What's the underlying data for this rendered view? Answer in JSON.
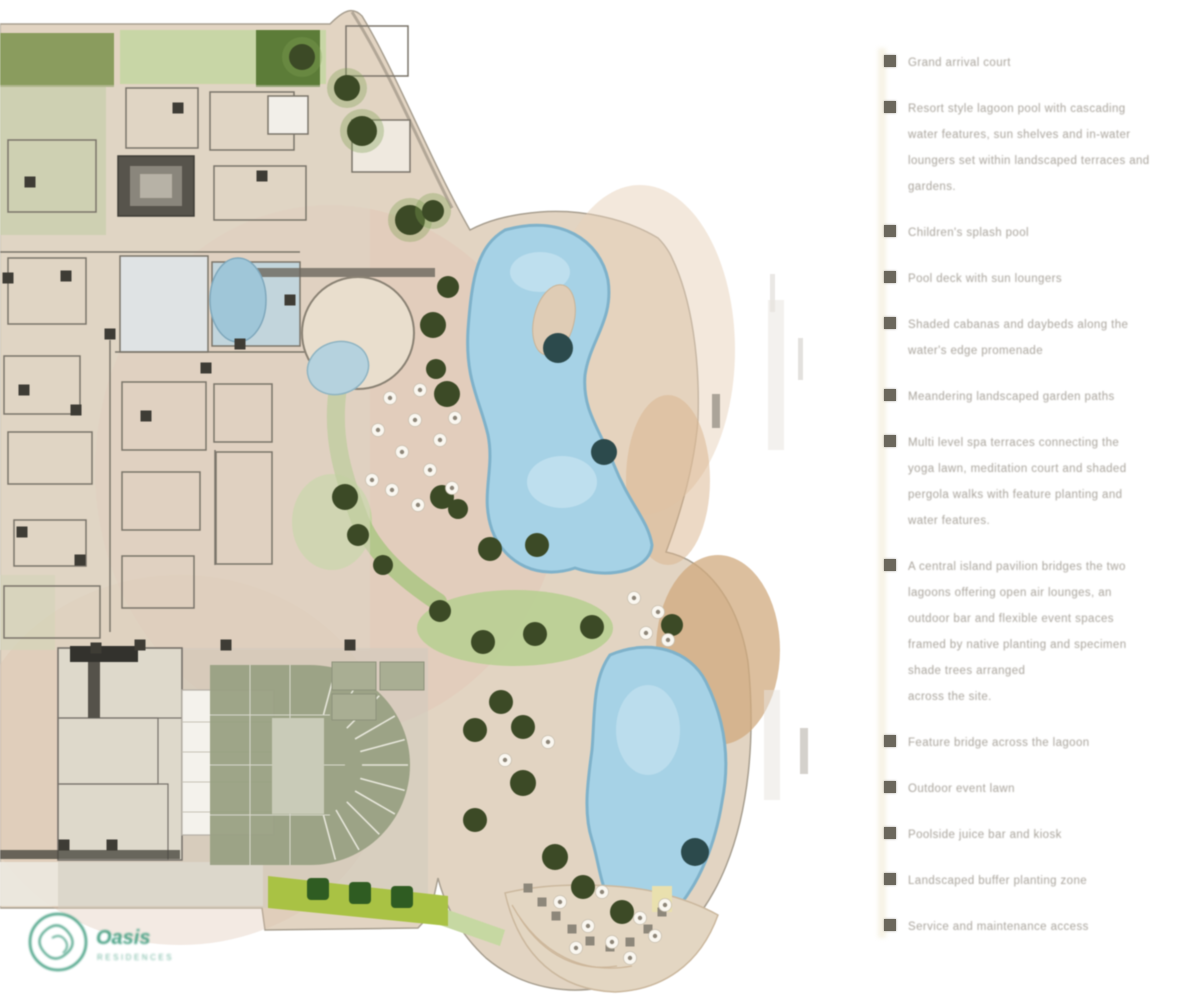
{
  "legend": {
    "items": [
      {
        "lines": [
          "Grand arrival court"
        ]
      },
      {
        "lines": [
          "Resort style lagoon pool with cascading",
          "water features, sun shelves and in-water",
          "loungers set within landscaped terraces and",
          "gardens."
        ]
      },
      {
        "lines": [
          "Children's splash pool"
        ]
      },
      {
        "lines": [
          "Pool deck with sun loungers"
        ]
      },
      {
        "lines": [
          "Shaded cabanas and daybeds along the",
          "water's edge promenade"
        ]
      },
      {
        "lines": [
          "Meandering landscaped garden paths"
        ]
      },
      {
        "lines": [
          "Multi level spa terraces connecting the",
          "yoga lawn, meditation court and shaded",
          "pergola walks with feature planting and",
          "water features."
        ]
      },
      {
        "lines": [
          "A central island pavilion bridges the two",
          "lagoons offering open air lounges, an",
          "outdoor bar and flexible event spaces",
          "framed by native planting and specimen",
          "shade trees arranged",
          "across the site."
        ]
      },
      {
        "lines": [
          "Feature bridge across the lagoon"
        ]
      },
      {
        "lines": [
          "Outdoor event lawn"
        ]
      },
      {
        "lines": [
          "Poolside juice bar and kiosk"
        ]
      },
      {
        "lines": [
          "Landscaped buffer planting zone"
        ]
      },
      {
        "lines": [
          "Service and maintenance access"
        ]
      }
    ]
  },
  "logo": {
    "name": "Oasis",
    "sub": "RESIDENCES"
  },
  "colors": {
    "water": "#a6d2e6",
    "water_edge": "#7fb2ca",
    "water_light": "#c9e4f1",
    "paving": "#e2d4c2",
    "paving_warm": "#e3c4b4",
    "tree": "#3c4a26",
    "tree_halo": "#7fa052",
    "tree_dark": "#2c4a4c",
    "lawn": "#b9cf92",
    "hedge": "#a9c244",
    "hedge_tree": "#2f5c22",
    "wall": "#7b756a",
    "dark_detail": "#3e3c35",
    "umbrella": "#faf7f0",
    "umbrella_dot": "#8d8578",
    "stone": "#8d877a",
    "legend_marker": "#6b675c",
    "legend_text": "#a9a49c",
    "logo_teal": "#4aa286"
  },
  "plan": {
    "trees": [
      [
        302,
        57,
        13
      ],
      [
        347,
        88,
        13
      ],
      [
        362,
        131,
        15
      ],
      [
        410,
        220,
        15
      ],
      [
        433,
        211,
        11
      ],
      [
        448,
        287,
        11
      ],
      [
        433,
        325,
        13
      ],
      [
        447,
        394,
        13
      ],
      [
        436,
        369,
        10
      ],
      [
        442,
        497,
        12
      ],
      [
        458,
        509,
        10
      ],
      [
        490,
        549,
        12
      ],
      [
        537,
        545,
        12
      ],
      [
        345,
        497,
        13
      ],
      [
        358,
        535,
        11
      ],
      [
        383,
        565,
        10
      ],
      [
        440,
        611,
        11
      ],
      [
        483,
        642,
        12
      ],
      [
        535,
        634,
        12
      ],
      [
        592,
        627,
        12
      ],
      [
        672,
        625,
        11
      ],
      [
        501,
        702,
        12
      ],
      [
        475,
        730,
        12
      ],
      [
        523,
        727,
        12
      ],
      [
        523,
        783,
        13
      ],
      [
        475,
        820,
        12
      ],
      [
        555,
        857,
        13
      ],
      [
        583,
        887,
        12
      ],
      [
        622,
        912,
        12
      ]
    ],
    "pool_trees": [
      [
        558,
        348,
        15
      ],
      [
        604,
        452,
        13
      ],
      [
        695,
        852,
        14
      ]
    ],
    "hedge_trees": [
      [
        318,
        878
      ],
      [
        360,
        882
      ],
      [
        402,
        886
      ]
    ],
    "umbrellas": [
      [
        390,
        398
      ],
      [
        415,
        420
      ],
      [
        378,
        430
      ],
      [
        402,
        452
      ],
      [
        430,
        470
      ],
      [
        392,
        490
      ],
      [
        418,
        505
      ],
      [
        440,
        440
      ],
      [
        455,
        418
      ],
      [
        372,
        480
      ],
      [
        452,
        488
      ],
      [
        420,
        390
      ],
      [
        634,
        598
      ],
      [
        658,
        612
      ],
      [
        646,
        633
      ],
      [
        668,
        640
      ],
      [
        505,
        760
      ],
      [
        548,
        742
      ],
      [
        560,
        902
      ],
      [
        588,
        926
      ],
      [
        612,
        942
      ],
      [
        640,
        918
      ],
      [
        602,
        892
      ],
      [
        576,
        948
      ],
      [
        630,
        958
      ],
      [
        655,
        936
      ],
      [
        665,
        905
      ]
    ],
    "stepping_stones": [
      [
        528,
        888
      ],
      [
        542,
        902
      ],
      [
        556,
        916
      ],
      [
        572,
        929
      ],
      [
        590,
        941
      ],
      [
        610,
        947
      ],
      [
        630,
        942
      ],
      [
        648,
        929
      ],
      [
        662,
        912
      ]
    ],
    "columns": [
      [
        8,
        278
      ],
      [
        66,
        276
      ],
      [
        110,
        334
      ],
      [
        76,
        410
      ],
      [
        24,
        390
      ],
      [
        146,
        416
      ],
      [
        206,
        368
      ],
      [
        240,
        344
      ],
      [
        22,
        532
      ],
      [
        80,
        560
      ],
      [
        30,
        182
      ],
      [
        262,
        176
      ],
      [
        178,
        108
      ],
      [
        96,
        648
      ],
      [
        140,
        645
      ],
      [
        226,
        645
      ],
      [
        350,
        645
      ],
      [
        64,
        845
      ],
      [
        112,
        845
      ],
      [
        290,
        300
      ]
    ]
  }
}
